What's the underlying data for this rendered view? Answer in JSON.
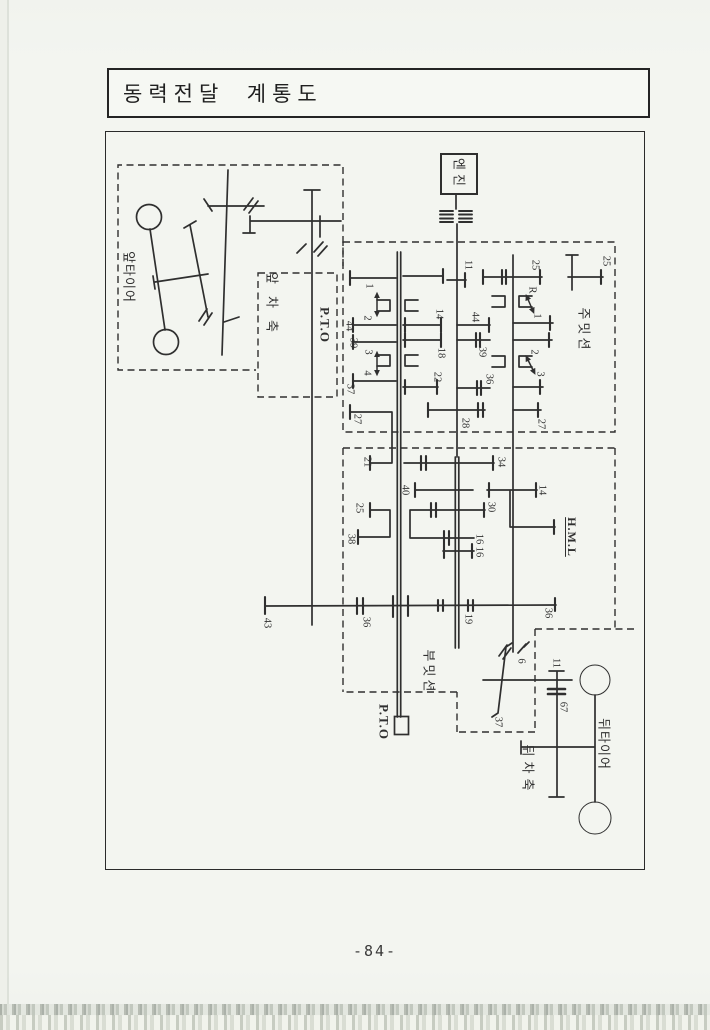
{
  "page": {
    "title": "동력전달  계통도",
    "page_number": "-84-"
  },
  "colors": {
    "ink": "#2f2f2f",
    "paper": "#f3f5f0",
    "background": "#e9ece6"
  },
  "diagram": {
    "labels": [
      {
        "text": "앞타이어",
        "x": 129,
        "y": 277,
        "rot": 90,
        "size": 13,
        "ls": 1,
        "name": "label-front-tire"
      },
      {
        "text": "앞차축",
        "x": 272,
        "y": 308,
        "rot": 90,
        "size": 13,
        "ls": 12,
        "name": "label-front-axle"
      },
      {
        "text": "P.T.O",
        "x": 325,
        "y": 325,
        "rot": 90,
        "size": 13,
        "ls": 1,
        "bold": true,
        "name": "label-pto-front"
      },
      {
        "text": "엔진",
        "x": 459,
        "y": 174,
        "rot": 90,
        "size": 13,
        "ls": 4,
        "name": "label-engine"
      },
      {
        "text": "주밋션",
        "x": 584,
        "y": 330,
        "rot": 90,
        "size": 13,
        "ls": 3,
        "name": "label-main-transmission"
      },
      {
        "text": "부밋션",
        "x": 429,
        "y": 672,
        "rot": 90,
        "size": 13,
        "ls": 3,
        "name": "label-sub-transmission"
      },
      {
        "text": "P.T.O",
        "x": 384,
        "y": 722,
        "rot": 90,
        "size": 13,
        "ls": 1,
        "bold": true,
        "name": "label-pto-rear"
      },
      {
        "text": "H.M.L",
        "x": 572,
        "y": 537,
        "rot": 90,
        "size": 12,
        "ls": 1,
        "bold": true,
        "ul": true,
        "name": "label-hml"
      },
      {
        "text": "뒤차축",
        "x": 528,
        "y": 770,
        "rot": 90,
        "size": 13,
        "ls": 5,
        "name": "label-rear-axle"
      },
      {
        "text": "뒤타이어",
        "x": 604,
        "y": 744,
        "rot": 90,
        "size": 13,
        "ls": 1,
        "name": "label-rear-tire"
      },
      {
        "text": "1",
        "x": 368,
        "y": 286,
        "rot": 90,
        "size": 10.5,
        "name": "gear-teeth-1"
      },
      {
        "text": "2",
        "x": 366,
        "y": 318,
        "rot": 90,
        "size": 10.5,
        "name": "gear-teeth-2"
      },
      {
        "text": "44",
        "x": 348,
        "y": 326,
        "rot": 90,
        "size": 10.5,
        "name": "gear-teeth-44"
      },
      {
        "text": "39",
        "x": 352,
        "y": 343,
        "rot": 90,
        "size": 10.5,
        "name": "gear-teeth-39"
      },
      {
        "text": "3",
        "x": 367,
        "y": 352,
        "rot": 90,
        "size": 10.5,
        "name": "gear-teeth-3"
      },
      {
        "text": "4",
        "x": 366,
        "y": 373,
        "rot": 90,
        "size": 10.5,
        "name": "gear-teeth-4"
      },
      {
        "text": "37",
        "x": 349,
        "y": 389,
        "rot": 90,
        "size": 10.5,
        "name": "gear-teeth-37"
      },
      {
        "text": "27",
        "x": 356,
        "y": 419,
        "rot": 90,
        "size": 10.5,
        "name": "gear-teeth-27"
      },
      {
        "text": "21",
        "x": 366,
        "y": 462,
        "rot": 90,
        "size": 10.5,
        "name": "gear-teeth-21"
      },
      {
        "text": "11",
        "x": 467,
        "y": 265,
        "rot": 90,
        "size": 10.5,
        "name": "gear-teeth-11"
      },
      {
        "text": "14",
        "x": 438,
        "y": 314,
        "rot": 90,
        "size": 10.5,
        "name": "gear-teeth-14"
      },
      {
        "text": "18",
        "x": 440,
        "y": 353,
        "rot": 90,
        "size": 10.5,
        "name": "gear-teeth-18"
      },
      {
        "text": "22",
        "x": 436,
        "y": 377,
        "rot": 90,
        "size": 10.5,
        "name": "gear-teeth-22"
      },
      {
        "text": "28",
        "x": 464,
        "y": 423,
        "rot": 90,
        "size": 10.5,
        "name": "gear-teeth-28"
      },
      {
        "text": "44",
        "x": 474,
        "y": 317,
        "rot": 90,
        "size": 10.5,
        "name": "gear-teeth-44b"
      },
      {
        "text": "39",
        "x": 481,
        "y": 352,
        "rot": 90,
        "size": 10.5,
        "name": "gear-teeth-39b"
      },
      {
        "text": "36",
        "x": 488,
        "y": 379,
        "rot": 90,
        "size": 10.5,
        "name": "gear-teeth-36b"
      },
      {
        "text": "25",
        "x": 534,
        "y": 265,
        "rot": 90,
        "size": 10.5,
        "name": "gear-teeth-25a"
      },
      {
        "text": "25",
        "x": 605,
        "y": 261,
        "rot": 90,
        "size": 10.5,
        "name": "gear-teeth-25b"
      },
      {
        "text": "R",
        "x": 531,
        "y": 290,
        "rot": 90,
        "size": 10.5,
        "name": "shift-label-r"
      },
      {
        "text": "1",
        "x": 536,
        "y": 316,
        "rot": 90,
        "size": 10.5,
        "name": "shift-label-1"
      },
      {
        "text": "2",
        "x": 533,
        "y": 352,
        "rot": 90,
        "size": 10.5,
        "name": "shift-label-2"
      },
      {
        "text": "3",
        "x": 539,
        "y": 374,
        "rot": 90,
        "size": 10.5,
        "name": "shift-label-3"
      },
      {
        "text": "27",
        "x": 540,
        "y": 424,
        "rot": 90,
        "size": 10.5,
        "name": "gear-teeth-27b"
      },
      {
        "text": "34",
        "x": 500,
        "y": 462,
        "rot": 90,
        "size": 10.5,
        "name": "gear-teeth-34"
      },
      {
        "text": "40",
        "x": 404,
        "y": 490,
        "rot": 90,
        "size": 10.5,
        "name": "gear-teeth-40"
      },
      {
        "text": "30",
        "x": 490,
        "y": 507,
        "rot": 90,
        "size": 10.5,
        "name": "gear-teeth-30"
      },
      {
        "text": "25",
        "x": 358,
        "y": 508,
        "rot": 90,
        "size": 10.5,
        "name": "gear-teeth-25c"
      },
      {
        "text": "38",
        "x": 350,
        "y": 539,
        "rot": 90,
        "size": 10.5,
        "name": "gear-teeth-38"
      },
      {
        "text": "16",
        "x": 478,
        "y": 539,
        "rot": 90,
        "size": 10.5,
        "name": "gear-teeth-16a"
      },
      {
        "text": "16",
        "x": 478,
        "y": 552,
        "rot": 90,
        "size": 10.5,
        "name": "gear-teeth-16b"
      },
      {
        "text": "14",
        "x": 541,
        "y": 490,
        "rot": 90,
        "size": 10.5,
        "name": "gear-teeth-14b"
      },
      {
        "text": "43",
        "x": 266,
        "y": 623,
        "rot": 90,
        "size": 10.5,
        "name": "gear-teeth-43"
      },
      {
        "text": "36",
        "x": 365,
        "y": 622,
        "rot": 90,
        "size": 10.5,
        "name": "gear-teeth-36c"
      },
      {
        "text": "19",
        "x": 467,
        "y": 619,
        "rot": 90,
        "size": 10.5,
        "name": "gear-teeth-19"
      },
      {
        "text": "36",
        "x": 547,
        "y": 613,
        "rot": 90,
        "size": 10.5,
        "name": "gear-teeth-36d"
      },
      {
        "text": "6",
        "x": 520,
        "y": 661,
        "rot": 90,
        "size": 10.5,
        "name": "gear-teeth-6"
      },
      {
        "text": "37",
        "x": 497,
        "y": 722,
        "rot": 90,
        "size": 10.5,
        "name": "gear-teeth-37b"
      },
      {
        "text": "11",
        "x": 555,
        "y": 663,
        "rot": 90,
        "size": 10.5,
        "name": "gear-teeth-11b"
      },
      {
        "text": "67",
        "x": 562,
        "y": 707,
        "rot": 90,
        "size": 10.5,
        "name": "gear-teeth-67"
      }
    ]
  }
}
